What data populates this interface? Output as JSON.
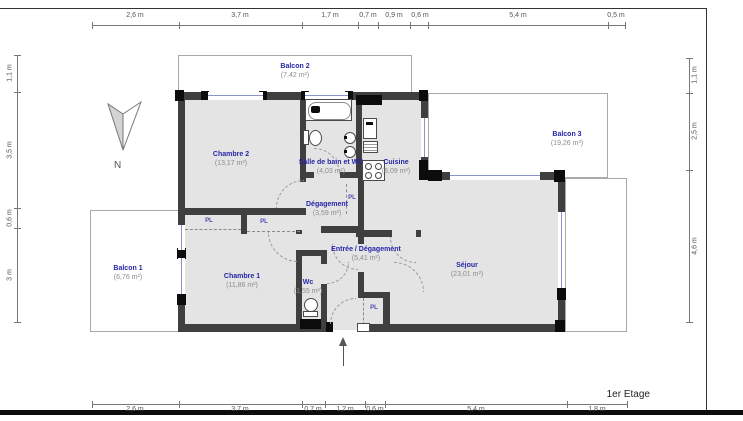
{
  "floor_label": "1er Etage",
  "compass": {
    "north_label": "N"
  },
  "closet_label": "PL",
  "rooms": [
    {
      "name": "Balcon 2",
      "area": "(7,42 m²)"
    },
    {
      "name": "Chambre 2",
      "area": "(13,17 m²)"
    },
    {
      "name": "Salle de bain et WC",
      "area": "(4,03 m²)"
    },
    {
      "name": "Cuisine",
      "area": "(8,09 m²)"
    },
    {
      "name": "Balcon 3",
      "area": "(19,26 m²)"
    },
    {
      "name": "Dégagement",
      "area": "(3,59 m²)"
    },
    {
      "name": "Entrée / Dégagement",
      "area": "(5,41 m²)"
    },
    {
      "name": "Chambre 1",
      "area": "(11,86 m²)"
    },
    {
      "name": "Balcon 1",
      "area": "(6,76 m²)"
    },
    {
      "name": "Wc",
      "area": "(1,55 m²)"
    },
    {
      "name": "Séjour",
      "area": "(23,01 m²)"
    }
  ],
  "dimensions": {
    "top": [
      "2,6 m",
      "3,7 m",
      "1,7 m",
      "0,7 m",
      "0,9 m",
      "0,6 m",
      "5,4 m",
      "0,5 m"
    ],
    "bottom": [
      "2,6 m",
      "3,7 m",
      "0,7 m",
      "1,2 m",
      "0,6 m",
      "5,4 m",
      "1,8 m"
    ],
    "left": [
      "1,1 m",
      "3,5 m",
      "0,6 m",
      "3 m"
    ],
    "right": [
      "1,1 m",
      "2,5 m",
      "4,6 m"
    ]
  }
}
